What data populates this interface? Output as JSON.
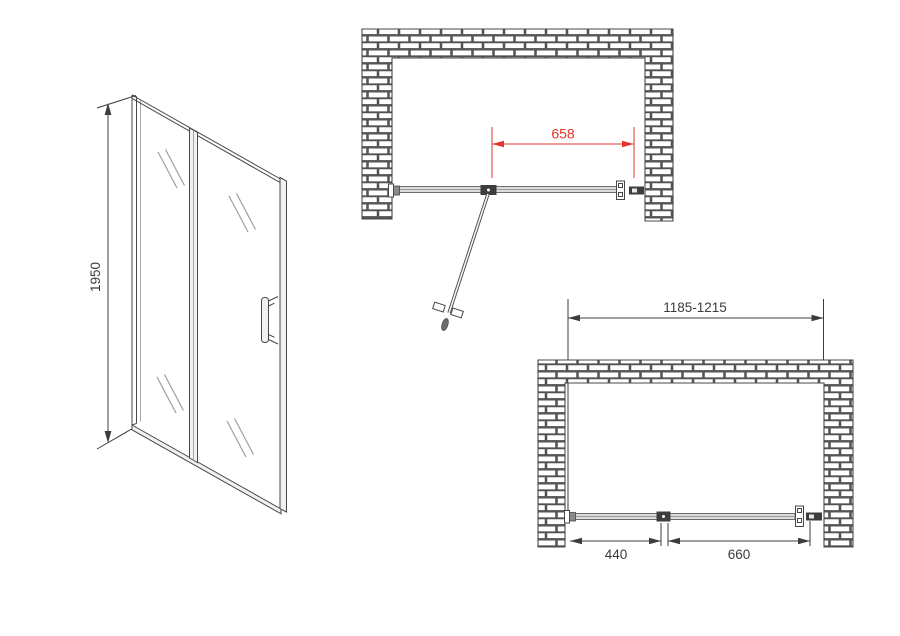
{
  "drawing": {
    "kind": "shower-door-installation-dimension-drawing",
    "colors": {
      "background": "#ffffff",
      "line": "#474747",
      "dim_black": "#3c3c3c",
      "dim_red": "#e4352a",
      "glass_fill": "#dcdcdc",
      "glass_edge": "#6e6e6e",
      "glass_mid": "#9c9c9c",
      "glass_mark": "#9f9f9f",
      "panel_fill": "#f1f1f1",
      "hardware_dark": "#3d3d3d",
      "hardware_light": "#ffffff",
      "hardware_gray": "#8a8a8a",
      "mortar": "#565656",
      "brick": "#ffffff"
    },
    "front_view": {
      "height": "1950"
    },
    "plan_open_view": {
      "door_opening": "658"
    },
    "plan_closed_view": {
      "overall_width": "1185-1215",
      "fixed_panel_width": "440",
      "door_width": "660"
    }
  }
}
